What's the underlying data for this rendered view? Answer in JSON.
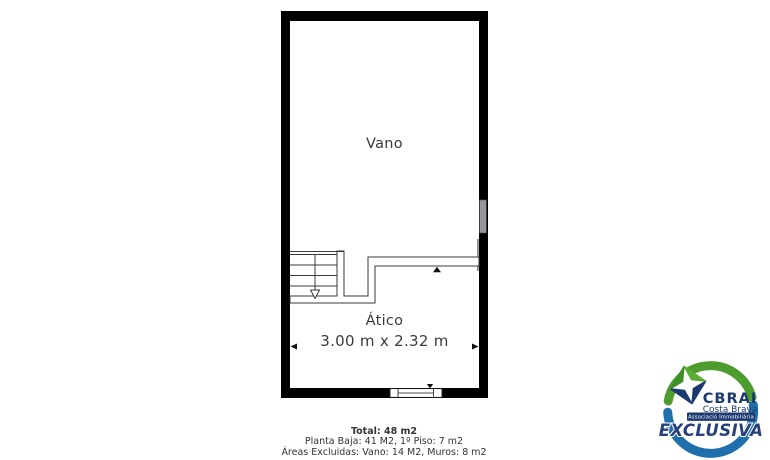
{
  "background": "#ffffff",
  "floor_plan": {
    "wall_color": "#000000",
    "line_color": "#3a3a3a",
    "rooms": [
      {
        "name": "Vano"
      },
      {
        "name": "Ático",
        "dimensions": "3.00 m x 2.32 m"
      }
    ],
    "stairs": {
      "direction": "down",
      "steps": 4
    },
    "windows": [
      {
        "wall": "right",
        "color": "#97979b"
      },
      {
        "wall": "bottom",
        "color": "#ffffff"
      }
    ]
  },
  "summary": {
    "total": "Total: 48 m2",
    "floors": "Planta Baja: 41 M2, 1º Piso: 7 m2",
    "excluded": "Áreas Excluidas: Vano: 14 M2, Muros: 8 m2"
  },
  "logo": {
    "brand": "CBRAI",
    "region": "Costa Brava",
    "association": "Associació Immobiliària",
    "badge": "EXCLUSIVA",
    "colors": {
      "green": "#4e9c2e",
      "green_dark": "#3e8f27",
      "green_light": "#5aac33",
      "blue": "#1f6fad",
      "navy": "#1d3a70",
      "badge_navy": "#27407c"
    }
  }
}
